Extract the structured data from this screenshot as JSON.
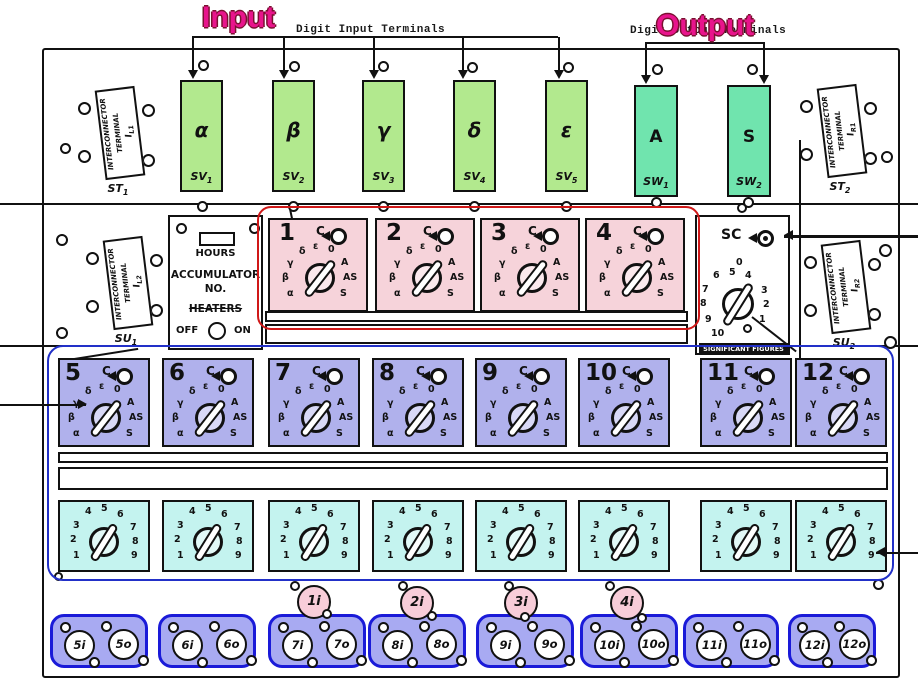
{
  "annotations": {
    "input_label": "Input",
    "output_label": "Output",
    "digit_input_label": "Digit Input Terminals",
    "digit_output_label": "Digit Output Terminals"
  },
  "colors": {
    "annotation_magenta": "#e8148c",
    "annotation_outline": "#7a1030",
    "annotation_red": "#d01818",
    "annotation_blue": "#2230c8",
    "input_terminal_green": "#b2e98e",
    "output_terminal_teal": "#70e4ae",
    "program_switch_pink": "#f6d3da",
    "program_switch_purple": "#b0b1ec",
    "repeat_switch_cyan": "#c4f3ef",
    "strip_fill": "#a8aaf2",
    "strip_border": "#1a1ad8",
    "program_input_fill": "#f8cdd9",
    "ink": "#111111"
  },
  "input_terminals": [
    {
      "letter": "α",
      "label": "SV",
      "sub": "1"
    },
    {
      "letter": "β",
      "label": "SV",
      "sub": "2"
    },
    {
      "letter": "γ",
      "label": "SV",
      "sub": "3"
    },
    {
      "letter": "δ",
      "label": "SV",
      "sub": "4"
    },
    {
      "letter": "ε",
      "label": "SV",
      "sub": "5"
    }
  ],
  "output_terminals": [
    {
      "letter": "A",
      "label": "SW",
      "sub": "1"
    },
    {
      "letter": "S",
      "label": "SW",
      "sub": "2"
    }
  ],
  "interconnectors": [
    {
      "line1": "INTERCONNECTOR",
      "line2": "TERMINAL",
      "id": "I",
      "id_sub": "L1",
      "caption": "ST",
      "caption_sub": "1"
    },
    {
      "line1": "INTERCONNECTOR",
      "line2": "TERMINAL",
      "id": "I",
      "id_sub": "R1",
      "caption": "ST",
      "caption_sub": "2"
    },
    {
      "line1": "INTERCONNECTOR",
      "line2": "TERMINAL",
      "id": "I",
      "id_sub": "L2",
      "caption": "SU",
      "caption_sub": "1"
    },
    {
      "line1": "INTERCONNECTOR",
      "line2": "TERMINAL",
      "id": "I",
      "id_sub": "R2",
      "caption": "SU",
      "caption_sub": "2"
    }
  ],
  "accumulator": {
    "hours": "HOURS",
    "name1": "ACCUMULATOR",
    "name2": "NO.",
    "heaters": "HEATERS",
    "off": "OFF",
    "on": "ON"
  },
  "significant_figures": {
    "label": "SC",
    "positions": [
      "0",
      "6",
      "5",
      "4",
      "7",
      "3",
      "8",
      "2",
      "9",
      "1",
      "10"
    ],
    "terminal_caption": "SIGNIFICANT FIGURES"
  },
  "operation_switches": {
    "c_label": "C",
    "positions": [
      "δ",
      "ε",
      "0",
      "γ",
      "A",
      "β",
      "AS",
      "α",
      "S"
    ],
    "numbers": [
      "1",
      "2",
      "3",
      "4",
      "5",
      "6",
      "7",
      "8",
      "9",
      "10",
      "11",
      "12"
    ]
  },
  "repeat_switches": {
    "positions": [
      "4",
      "5",
      "6",
      "3",
      "7",
      "2",
      "8",
      "1",
      "9"
    ]
  },
  "program_inputs": [
    "1i",
    "2i",
    "3i",
    "4i"
  ],
  "terminal_strips": [
    {
      "in": "5i",
      "out": "5o"
    },
    {
      "in": "6i",
      "out": "6o"
    },
    {
      "in": "7i",
      "out": "7o"
    },
    {
      "in": "8i",
      "out": "8o"
    },
    {
      "in": "9i",
      "out": "9o"
    },
    {
      "in": "10i",
      "out": "10o"
    },
    {
      "in": "11i",
      "out": "11o"
    },
    {
      "in": "12i",
      "out": "12o"
    }
  ]
}
